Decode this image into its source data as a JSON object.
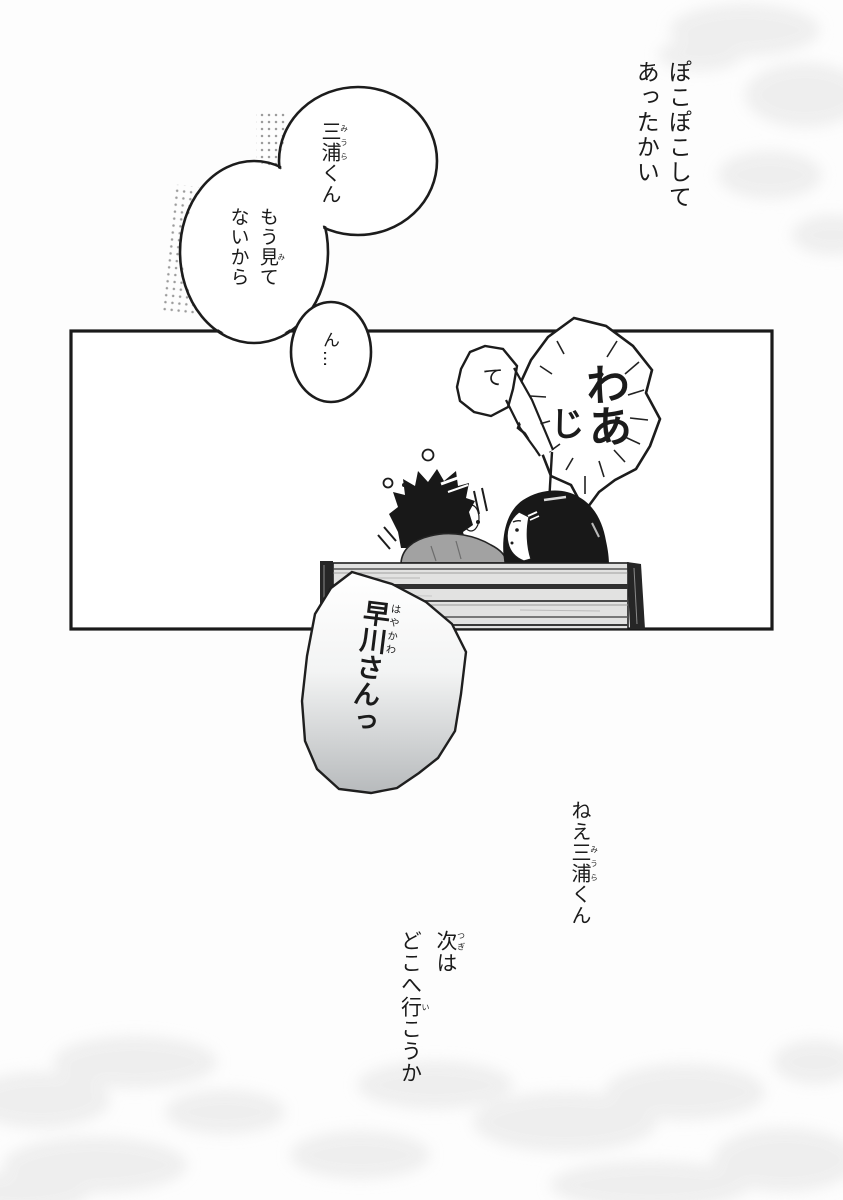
{
  "page": {
    "type": "manga-page",
    "bg_color": "#fdfdfd",
    "ink_color": "#1b1b1b",
    "bench_plank_color": "#e2e2e1",
    "sweater_color": "#a2a2a2",
    "shout_bubble_gradient_bottom": "#b7babc"
  },
  "narration": {
    "warmth_line1": "ぽこぽこして",
    "warmth_line2": "あったかい",
    "nee_miura_segments": [
      [
        "ねえ"
      ],
      [
        "三浦",
        "みうら"
      ],
      [
        "くん"
      ]
    ],
    "next_line1_segments": [
      [
        "次",
        "つぎ"
      ],
      [
        "は"
      ]
    ],
    "next_line2_segments": [
      [
        "どこへ"
      ],
      [
        "行",
        "い"
      ],
      [
        "こうか"
      ]
    ]
  },
  "speech": {
    "miura_kun_segments": [
      [
        "三浦",
        "みうら"
      ],
      [
        "くん"
      ]
    ],
    "not_looking_line1_segments": [
      [
        "もう"
      ],
      [
        "見",
        "み"
      ],
      [
        "て"
      ]
    ],
    "not_looking_line2_segments": [
      [
        "ないから"
      ]
    ],
    "hmm": "ん…",
    "te": "て",
    "waa": "わあ",
    "ji": "じ",
    "hayakawa_segments": [
      [
        "早川",
        "はやかわ"
      ],
      [
        "さんっ"
      ]
    ]
  },
  "scene": {
    "characters": [
      "boy-black-hair",
      "girl-long-hair-hairclip"
    ],
    "props": [
      "wooden-bench"
    ],
    "effects": [
      "halftone-dots",
      "sweat-drops",
      "motion-lines",
      "corner-wash-texture"
    ]
  }
}
